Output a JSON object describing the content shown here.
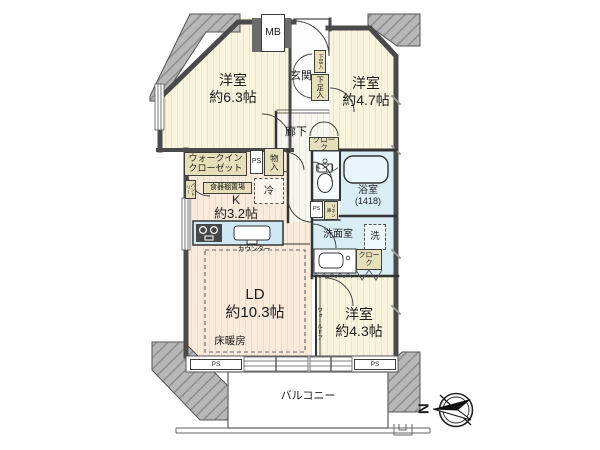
{
  "rooms": [
    {
      "id": "bedroom-63",
      "name": "洋室",
      "size": "約6.3帖"
    },
    {
      "id": "bedroom-47",
      "name": "洋室",
      "size": "約4.7帖"
    },
    {
      "id": "bedroom-43",
      "name": "洋室",
      "size": "約4.3帖"
    },
    {
      "id": "living-dining",
      "name": "LD",
      "size": "約10.3帖"
    },
    {
      "id": "kitchen",
      "name": "K",
      "size": "約3.2帖"
    }
  ],
  "labels": {
    "entrance": "玄関",
    "hallway": "廊下",
    "toilet": "トイレ",
    "bathroom": "浴室",
    "bathroom_size": "(1418)",
    "washroom": "洗面室",
    "washer": "洗",
    "fridge": "冷",
    "balcony": "バルコニー",
    "floor_heating": "床暖房",
    "counter": "カウンター",
    "wall_door": "ウォールドア",
    "wic_line1": "ウォークイン",
    "wic_line2": "クローゼット",
    "dish_shelf": "食器棚置場",
    "pantry": "パントリー",
    "storage": "物入",
    "cloak": "クローク",
    "linen": "リネン庫",
    "shoe_cabinet": "下足入",
    "meter_box": "MB",
    "pipe_space": "PS",
    "north": "N"
  },
  "colors": {
    "bedroom_floor": "#f8f4df",
    "ldk_floor": "#f9eadb",
    "wet_floor": "#d9edf5",
    "closet_fill": "#e7dfb9",
    "wall": "#4a4a4a",
    "counter_fill": "#cfe9f4",
    "hatch_fill": "#b7b7b7"
  }
}
